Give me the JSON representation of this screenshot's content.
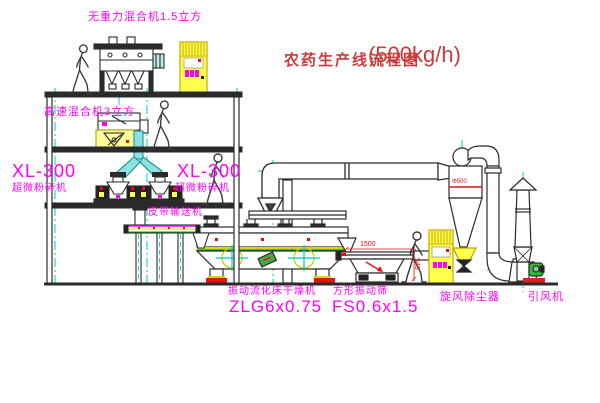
{
  "title": {
    "name": "农药生产线流程图",
    "capacity": "(500kg/h)"
  },
  "equipment": {
    "top_mixer": {
      "label": "无重力混合机1.5立方"
    },
    "high_speed_mixer": {
      "label": "高速混合机3立方"
    },
    "mill_left": {
      "model": "XL-300",
      "label": "超微粉碎机"
    },
    "mill_right": {
      "model": "XL-300",
      "label": "超微粉碎机"
    },
    "belt_conveyor": {
      "label": "皮带输送机"
    },
    "dryer": {
      "label": "振动流化床干燥机",
      "model": "ZLG6x0.75"
    },
    "sieve": {
      "label": "方形振动筛",
      "model": "FS0.6x1.5"
    },
    "cyclone": {
      "label": "旋风除尘器",
      "diameter": "Φ500"
    },
    "fan": {
      "label": "引风机"
    }
  },
  "dimensions": {
    "sieve_length": "1500",
    "sieve_height": "545"
  },
  "colors": {
    "label_magenta": "#ff00ff",
    "title_red": "#c83c3c",
    "centerline_cyan": "#00c8c8",
    "line_dark": "#2b2b2b",
    "accent_yellow": "#ffff4d",
    "accent_red": "#e81010",
    "pipe_cyan_fill": "#8fe0e0",
    "fan_green": "#3db53d"
  }
}
